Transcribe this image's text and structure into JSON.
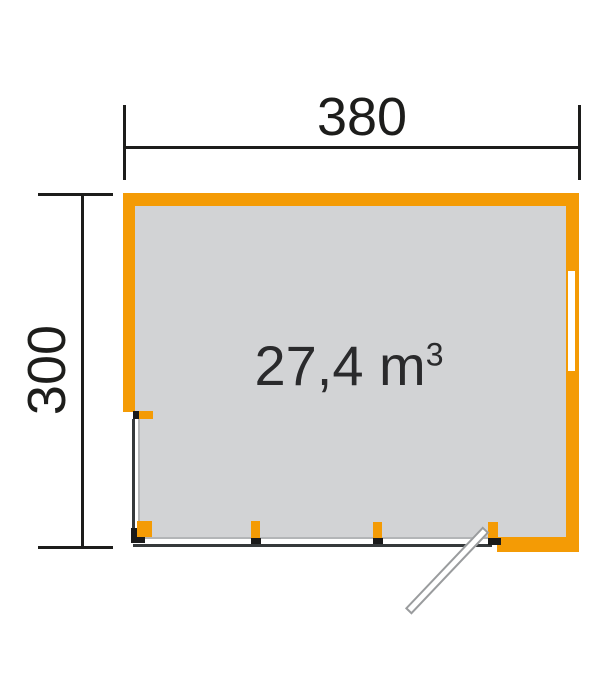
{
  "diagram": {
    "width_dimension": "380",
    "height_dimension": "300",
    "volume_value": "27,4 m",
    "volume_superscript": "3",
    "colors": {
      "wall_orange": "#f49b05",
      "floor_gray": "#d2d3d5",
      "line_black": "#1d1d1b",
      "mark_black": "#1a1a1a",
      "glaze_light": "#b3b5b7",
      "glaze_dark": "#35393b",
      "door_gray": "#9a9c9e"
    }
  }
}
